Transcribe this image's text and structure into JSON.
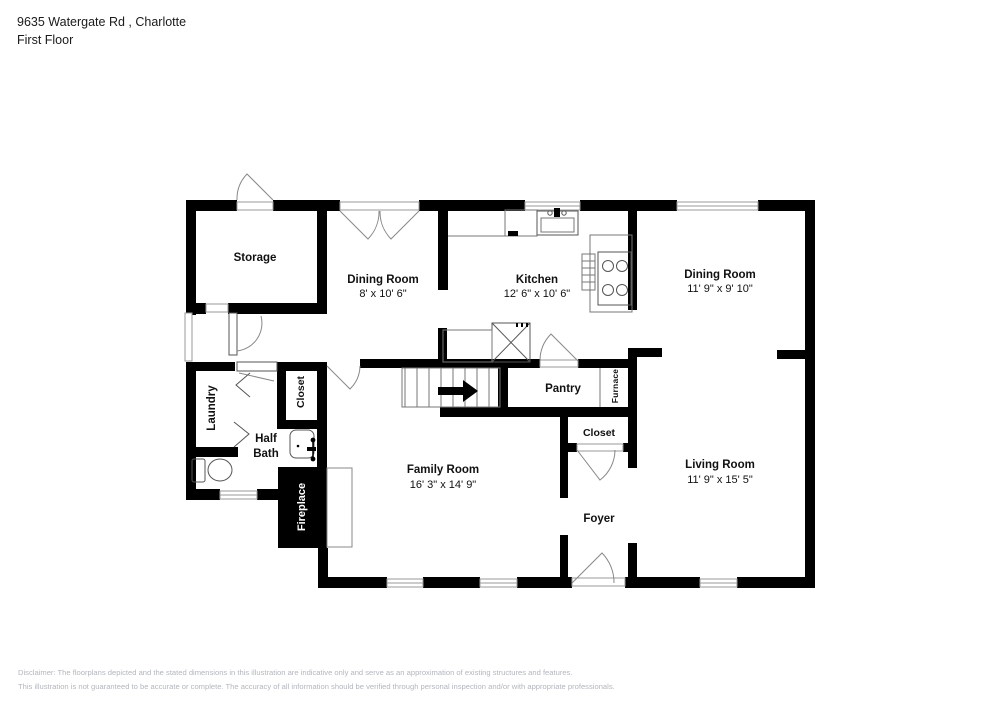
{
  "header": {
    "address": "9635 Watergate Rd , Charlotte",
    "floor": "First Floor"
  },
  "rooms": {
    "storage": {
      "name": "Storage"
    },
    "dining_left": {
      "name": "Dining Room",
      "dims": "8' x 10' 6\""
    },
    "kitchen": {
      "name": "Kitchen",
      "dims": "12' 6\" x 10' 6\""
    },
    "dining_right": {
      "name": "Dining Room",
      "dims": "11' 9\" x 9' 10\""
    },
    "laundry": {
      "name": "Laundry"
    },
    "hall_closet": {
      "name": "Closet"
    },
    "pantry": {
      "name": "Pantry"
    },
    "furnace": {
      "name": "Furnace"
    },
    "half_bath": {
      "name": "Half Bath"
    },
    "foyer_closet": {
      "name": "Closet"
    },
    "family_room": {
      "name": "Family Room",
      "dims": "16' 3\" x 14' 9\""
    },
    "living_room": {
      "name": "Living Room",
      "dims": "11' 9\" x 15' 5\""
    },
    "foyer": {
      "name": "Foyer"
    },
    "fireplace": {
      "name": "Fireplace"
    }
  },
  "disclaimer": {
    "line1": "Disclaimer: The floorplans depicted and the stated dimensions in this illustration are indicative only and serve as an approximation of existing structures and features.",
    "line2": "This illustration is not guaranteed to be accurate or complete. The accuracy of all information should be verified through personal inspection and/or with appropriate professionals."
  },
  "colors": {
    "wall": "#000000",
    "label": "#111111",
    "disclaimer": "#b3b6bd"
  }
}
